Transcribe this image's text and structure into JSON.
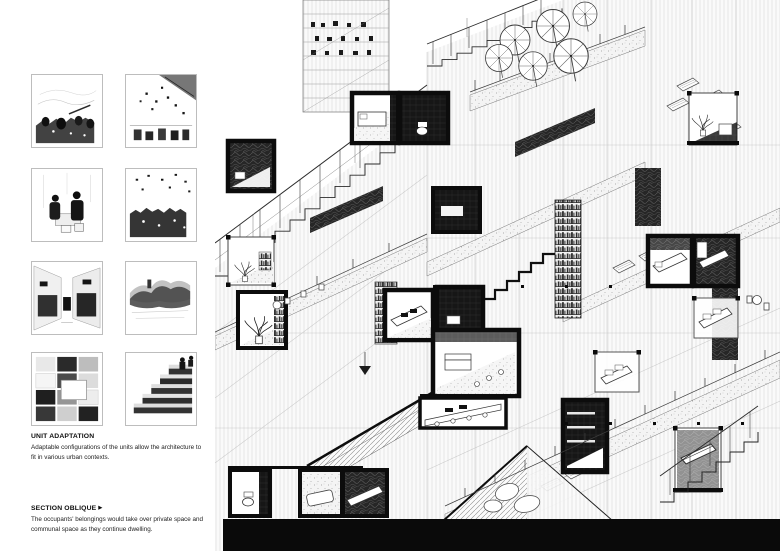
{
  "board": {
    "background": "#ffffff",
    "ink": "#0d0d0d"
  },
  "sidebar": {
    "thumbnails": [
      {
        "name": "street-market-crowd-sketch"
      },
      {
        "name": "canopy-street-festival-sketch"
      },
      {
        "name": "market-vendors-sketch"
      },
      {
        "name": "crowded-plaza-sketch"
      },
      {
        "name": "alley-shophouses-sketch"
      },
      {
        "name": "hillside-rooftops-sketch"
      },
      {
        "name": "photo-collage-wall-sketch"
      },
      {
        "name": "occupied-stair-terraces-sketch"
      }
    ],
    "sections": [
      {
        "heading": "UNIT ADAPTATION",
        "arrow": "",
        "body": "Adaptable configurations of the units allow the architecture to fit in various urban contexts."
      },
      {
        "heading": "SECTION OBLIQUE",
        "arrow": "▶",
        "body": "The occupants' belongings would take over private space and communal space as they continue dwelling."
      }
    ]
  },
  "drawing": {
    "name": "section-oblique-drawing",
    "description": "Sectional oblique of stacked dwelling units: stairs, terraces with parasols, black-framed cut units, bookshelves, vegetation and belongings over communal space"
  }
}
